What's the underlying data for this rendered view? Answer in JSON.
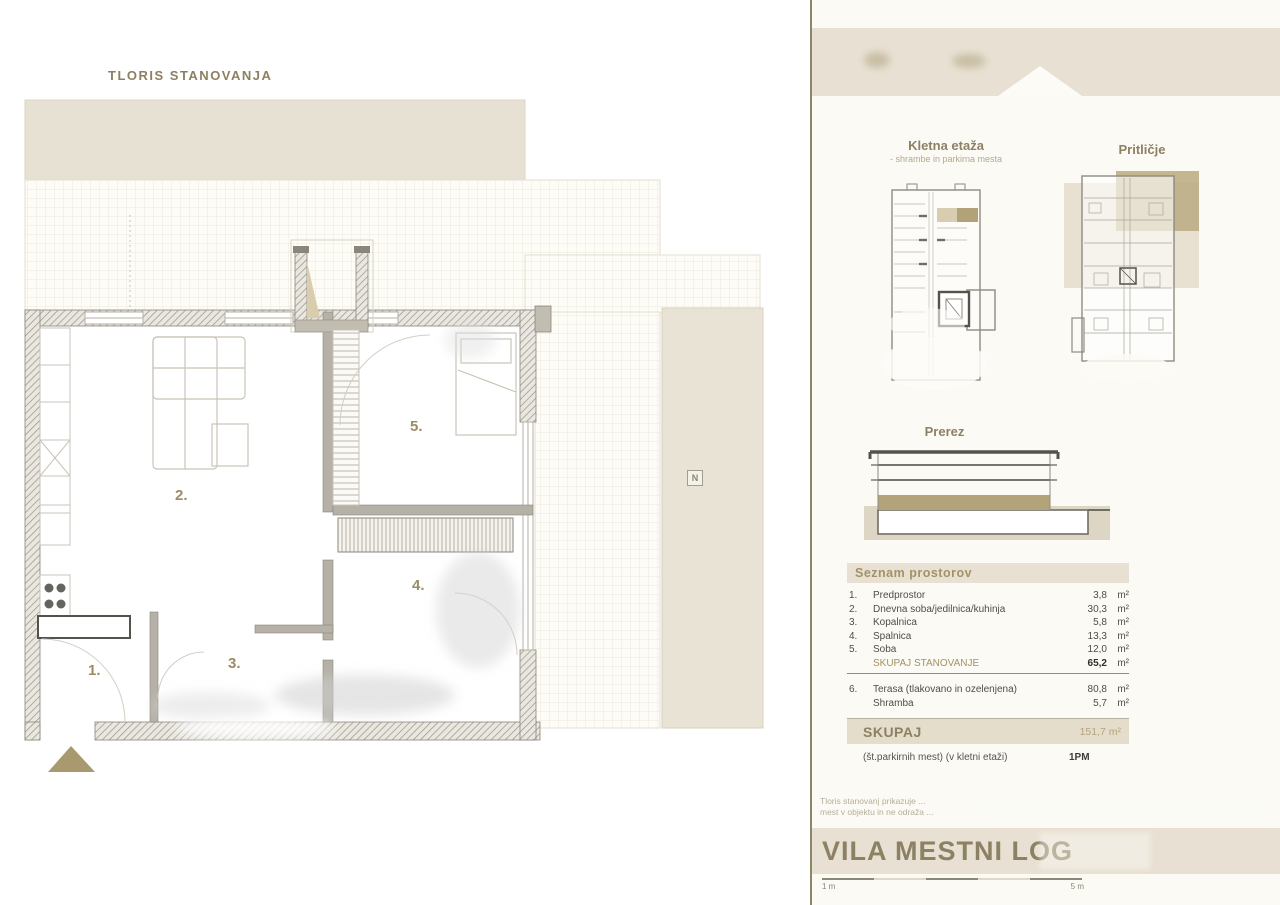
{
  "plan": {
    "title": "TLORIS STANOVANJA",
    "compass_label": "N",
    "room_labels": [
      "1.",
      "2.",
      "3.",
      "4.",
      "5."
    ]
  },
  "sidebar": {
    "basement_plan": {
      "title": "Kletna etaža",
      "subtitle": "- shrambe in parkirna mesta"
    },
    "ground_plan": {
      "title": "Pritličje"
    },
    "section": {
      "title": "Prerez"
    },
    "room_list": {
      "header": "Seznam prostorov",
      "rows": [
        {
          "num": "1.",
          "name": "Predprostor",
          "area": "3,8",
          "unit": "m²"
        },
        {
          "num": "2.",
          "name": "Dnevna soba/jedilnica/kuhinja",
          "area": "30,3",
          "unit": "m²"
        },
        {
          "num": "3.",
          "name": "Kopalnica",
          "area": "5,8",
          "unit": "m²"
        },
        {
          "num": "4.",
          "name": "Spalnica",
          "area": "13,3",
          "unit": "m²"
        },
        {
          "num": "5.",
          "name": "Soba",
          "area": "12,0",
          "unit": "m²"
        }
      ],
      "subtotal": {
        "num": "",
        "label": "SKUPAJ STANOVANJE",
        "area": "65,2",
        "unit": "m²"
      },
      "extra_rows": [
        {
          "num": "6.",
          "name": "Terasa (tlakovano in ozelenjena)",
          "area": "80,8",
          "unit": "m²"
        },
        {
          "num": "",
          "name": "Shramba",
          "area": "5,7",
          "unit": "m²"
        }
      ],
      "total": {
        "label": "SKUPAJ",
        "value": "151,7 m²"
      },
      "parking": {
        "label": "(št.parkirnih mest) (v kletni etaži)",
        "value": "1PM"
      }
    },
    "disclaimer": {
      "line1": "Tloris stanovanj prikazuje ...",
      "line2": "mest v objektu in ne odraža ..."
    },
    "project_title": "VILA MESTNI LOG",
    "scale": {
      "left_label": "1 m",
      "right_label": "5 m"
    }
  },
  "colors": {
    "accent_olive": "#8d8164",
    "accent_tan": "#b2a47c",
    "band_beige": "#e8e1d3",
    "highlight_tan": "#b3a37a"
  }
}
